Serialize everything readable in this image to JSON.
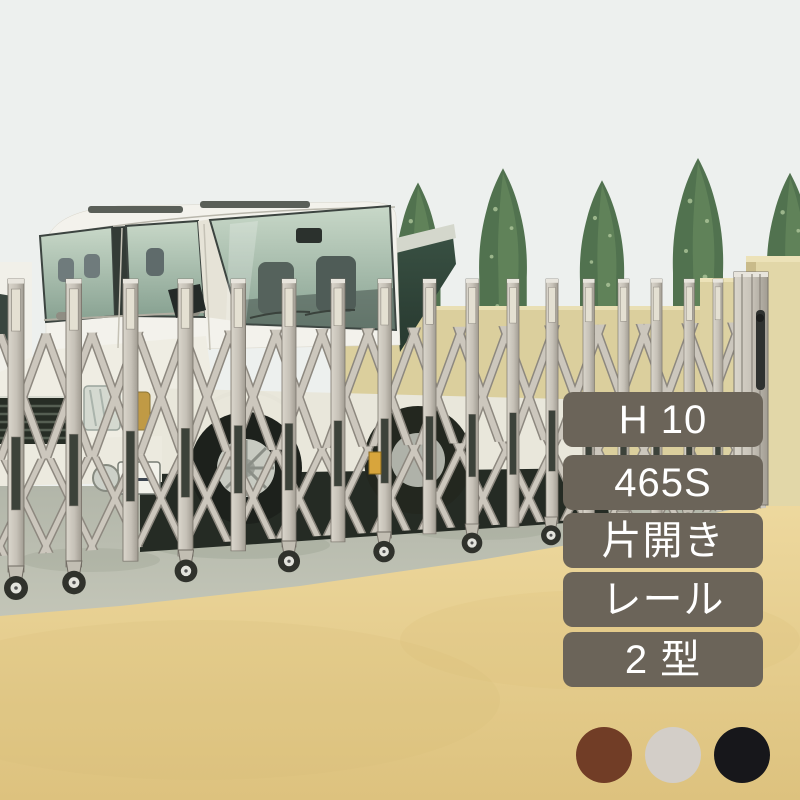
{
  "spec_badges": {
    "bg": "#6B6459",
    "text_color": "#FFFFFF",
    "items": [
      "H 10",
      "465S",
      "片開き",
      "レール",
      "2 型"
    ]
  },
  "color_swatches": {
    "items": [
      {
        "name": "brown",
        "hex": "#713D26"
      },
      {
        "name": "light-gray",
        "hex": "#D3CEC8"
      },
      {
        "name": "black",
        "hex": "#17171B"
      }
    ]
  },
  "scene": {
    "colors": {
      "sky": "#EDF0EE",
      "wall": "#DBCF9D",
      "pillar": "#E2D7A8",
      "gate_metal": "#C9C4BA",
      "concrete": "#BCC0B3",
      "sand": "#E6D092",
      "tree_green": "#51724F",
      "car_body": "#F3F2EC"
    }
  }
}
